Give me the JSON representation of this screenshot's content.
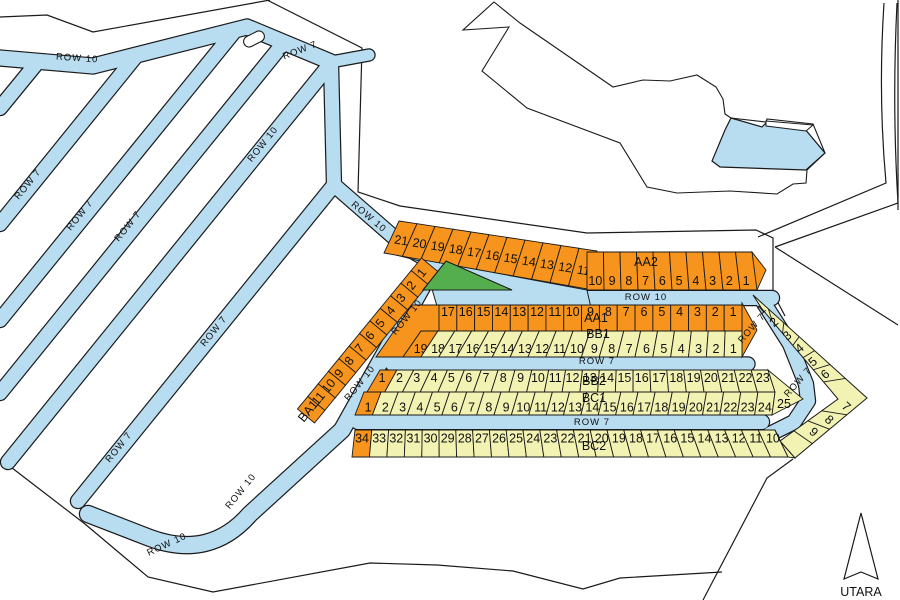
{
  "map": {
    "title": "site-plan",
    "compass": {
      "label": "UTARA"
    },
    "roads": {
      "row7_label": "ROW 7",
      "row10_label": "ROW 10"
    },
    "colors": {
      "road": "#B8DCF0",
      "water": "#B8DCF0",
      "plot_orange": "#F7941E",
      "plot_yellow": "#F2F2B3",
      "green_area": "#55AE4E",
      "line": "#1a1a1a"
    },
    "sections": {
      "AA2": {
        "label": "AA2",
        "numbers_slant": [
          21,
          20,
          19,
          18,
          17,
          16,
          15,
          14,
          13,
          12,
          11
        ],
        "numbers_flat": [
          10,
          9,
          8,
          7,
          6,
          5,
          4,
          3,
          2,
          1
        ]
      },
      "AA1": {
        "label": "AA1",
        "numbers": [
          17,
          16,
          15,
          14,
          13,
          12,
          11,
          10,
          9,
          8,
          7,
          6,
          5,
          4,
          3,
          2,
          1
        ]
      },
      "BB1": {
        "label": "BB1",
        "numbers": [
          19,
          18,
          17,
          16,
          15,
          14,
          13,
          12,
          11,
          10,
          9,
          8,
          7,
          6,
          5,
          4,
          3,
          2,
          1
        ]
      },
      "BB2": {
        "label": "BB2",
        "numbers": [
          1,
          2,
          3,
          4,
          5,
          6,
          7,
          8,
          9,
          10,
          11,
          12,
          13,
          14,
          15,
          16,
          17,
          18,
          19,
          20,
          21,
          22,
          23
        ]
      },
      "BC1": {
        "label": "BC1",
        "numbers": [
          1,
          2,
          3,
          4,
          5,
          6,
          7,
          8,
          9,
          10,
          11,
          12,
          13,
          14,
          15,
          16,
          17,
          18,
          19,
          20,
          21,
          22,
          23,
          24
        ],
        "tip_number": 25
      },
      "BC2": {
        "label": "BC2",
        "numbers_bend": [
          1,
          2,
          3,
          4,
          5,
          6,
          7,
          8,
          9
        ],
        "numbers_row": [
          34,
          33,
          32,
          31,
          30,
          29,
          28,
          27,
          26,
          25,
          24,
          23,
          22,
          21,
          20,
          19,
          18,
          17,
          16,
          15,
          14,
          13,
          12,
          11,
          10
        ]
      },
      "BA1": {
        "label": "BA1",
        "numbers": [
          1,
          2,
          3,
          4,
          5,
          6,
          7,
          8,
          9,
          10,
          11
        ]
      }
    }
  }
}
